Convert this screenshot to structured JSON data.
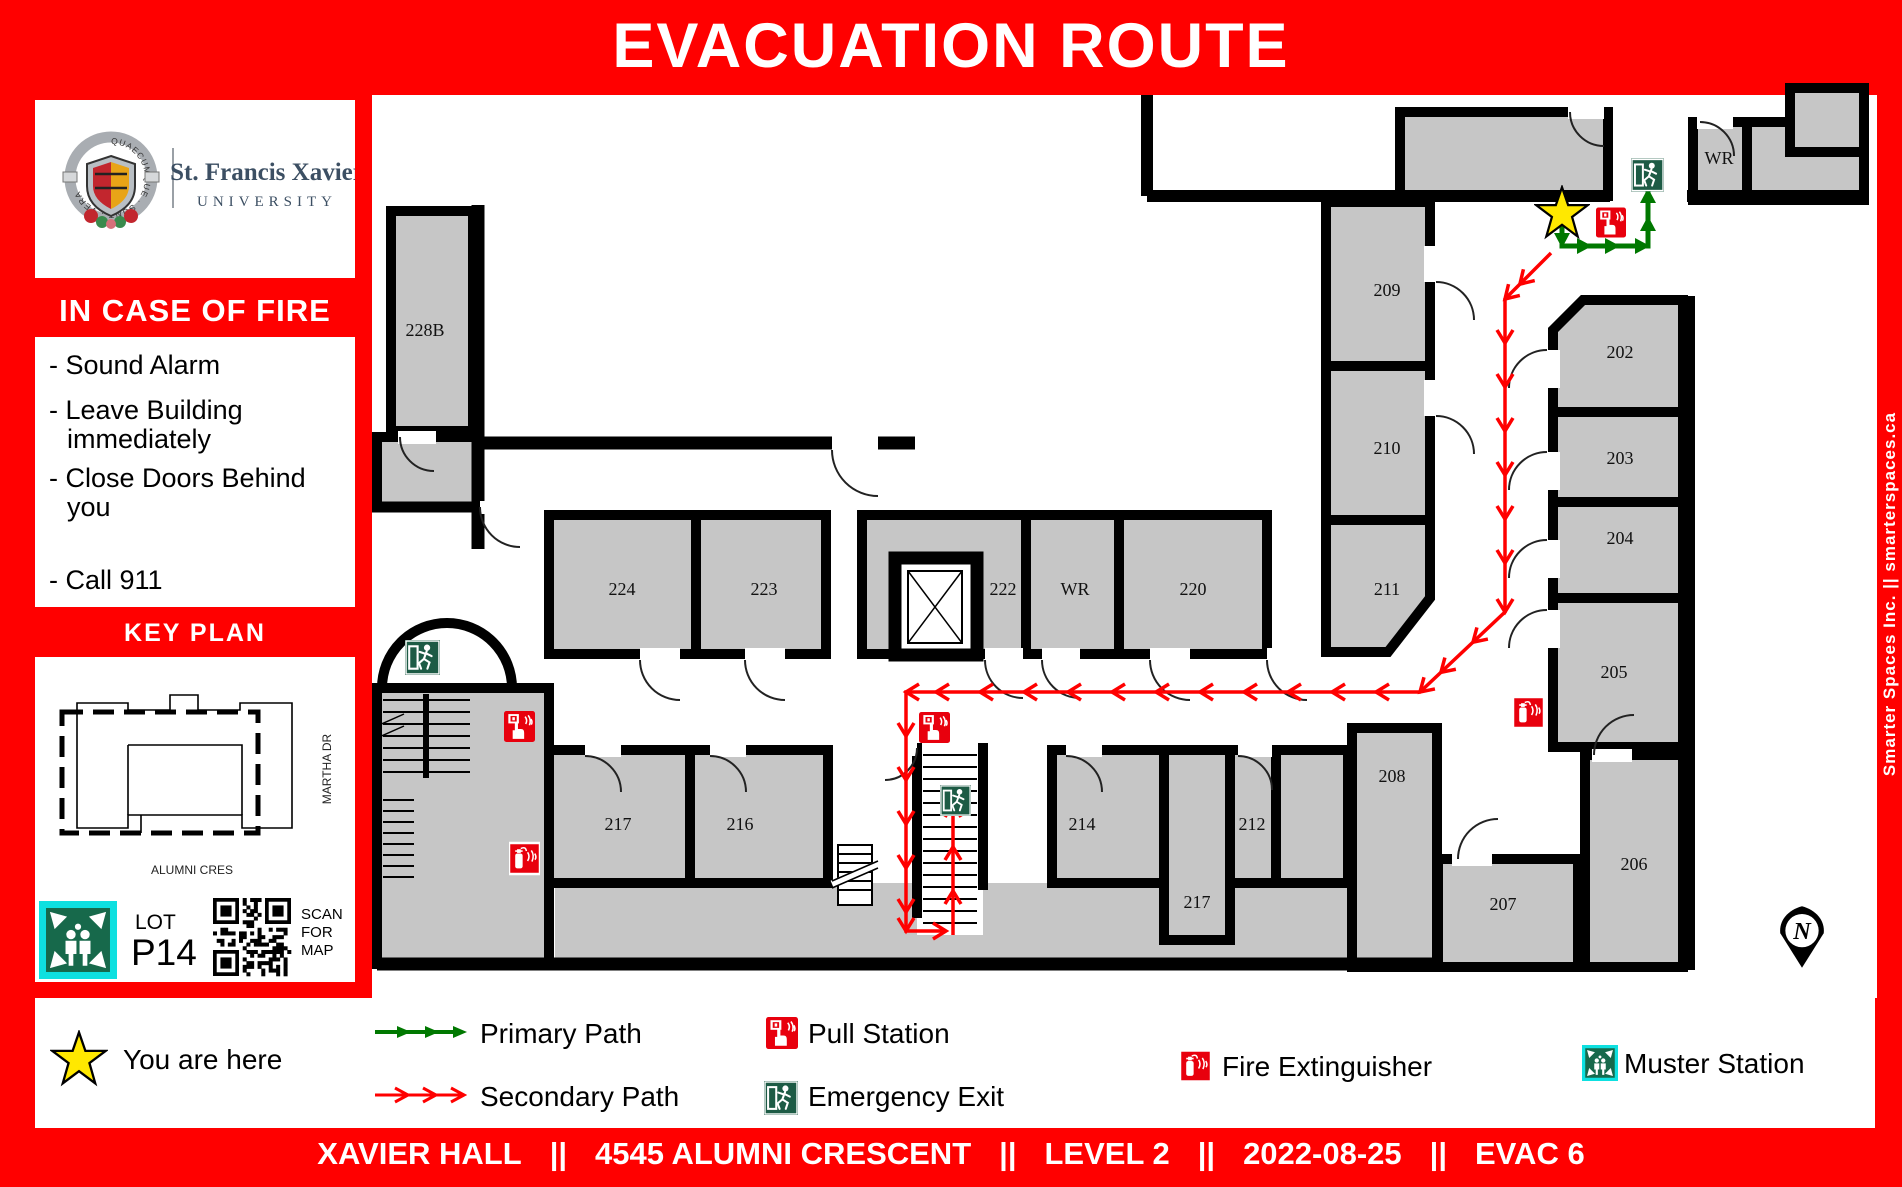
{
  "header": {
    "title": "EVACUATION ROUTE"
  },
  "right_rail": {
    "text": "Smarter Spaces Inc.    ||    smarterspaces.ca"
  },
  "sidebar": {
    "university": {
      "line1": "St. Francis Xavier",
      "line2": "UNIVERSITY",
      "motto": "QUAECUMQUE · SUNT · VERA"
    },
    "fire_heading": "IN CASE OF FIRE",
    "instructions": [
      {
        "lines": [
          "- Sound Alarm"
        ]
      },
      {
        "lines": [
          "- Leave Building",
          "immediately"
        ]
      },
      {
        "lines": [
          "- Close Doors Behind",
          "you"
        ]
      },
      {
        "lines": [
          "- Call 911"
        ]
      }
    ],
    "key_plan": {
      "heading": "KEY PLAN",
      "street_right": "MARTHA DR",
      "street_bottom": "ALUMNI CRES",
      "lot_label": "LOT",
      "lot_value": "P14",
      "qr_caption": [
        "SCAN",
        "FOR",
        "MAP"
      ]
    }
  },
  "floorplan": {
    "north_label": "N",
    "rooms": [
      {
        "label": "228B",
        "cx": 425,
        "cy": 330,
        "rect": [
          391,
          211,
          82,
          220
        ]
      },
      {
        "label": "224",
        "cx": 622,
        "cy": 589,
        "rect": [
          549,
          515,
          147,
          139
        ]
      },
      {
        "label": "223",
        "cx": 764,
        "cy": 589,
        "rect": [
          696,
          515,
          130,
          139
        ]
      },
      {
        "label": "222",
        "cx": 1003,
        "cy": 589,
        "rect": [
          862,
          515,
          164,
          139
        ]
      },
      {
        "label": "WR",
        "cx": 1075,
        "cy": 589,
        "rect": [
          1026,
          515,
          93,
          139
        ]
      },
      {
        "label": "220",
        "cx": 1193,
        "cy": 589,
        "rect": [
          1119,
          515,
          148,
          139
        ]
      },
      {
        "label": "209",
        "cx": 1387,
        "cy": 290
      },
      {
        "label": "210",
        "cx": 1387,
        "cy": 448
      },
      {
        "label": "211",
        "cx": 1387,
        "cy": 589
      },
      {
        "label": "202",
        "cx": 1620,
        "cy": 352
      },
      {
        "label": "203",
        "cx": 1620,
        "cy": 458,
        "rect": [
          1553,
          412,
          130,
          90
        ]
      },
      {
        "label": "204",
        "cx": 1620,
        "cy": 538,
        "rect": [
          1553,
          502,
          130,
          96
        ]
      },
      {
        "label": "205",
        "cx": 1614,
        "cy": 672,
        "rect": [
          1553,
          598,
          130,
          149
        ]
      },
      {
        "label": "206",
        "cx": 1634,
        "cy": 864,
        "rect": [
          1585,
          755,
          98,
          212
        ]
      },
      {
        "label": "207",
        "cx": 1503,
        "cy": 904,
        "rect": [
          1438,
          859,
          140,
          108
        ]
      },
      {
        "label": "208",
        "cx": 1392,
        "cy": 776,
        "rect": [
          1352,
          728,
          85,
          239
        ]
      },
      {
        "label": "217",
        "cx": 618,
        "cy": 824,
        "rect": [
          549,
          750,
          141,
          133
        ]
      },
      {
        "label": "216",
        "cx": 740,
        "cy": 824,
        "rect": [
          690,
          750,
          138,
          133
        ]
      },
      {
        "label": "214",
        "cx": 1082,
        "cy": 824,
        "rect": [
          1052,
          750,
          112,
          133
        ]
      },
      {
        "label": "217",
        "cx": 1197,
        "cy": 902,
        "rect": [
          1164,
          750,
          66,
          190
        ]
      },
      {
        "label": "212",
        "cx": 1252,
        "cy": 824,
        "rect": [
          1230,
          750,
          46,
          133
        ]
      },
      {
        "label": "WR",
        "cx": 1719,
        "cy": 158,
        "rect": [
          1693,
          122,
          54,
          78
        ]
      }
    ],
    "icons": [
      {
        "type": "star",
        "name": "you-are-here-star",
        "x": 1534,
        "y": 185,
        "w": 56,
        "h": 56
      },
      {
        "type": "pull",
        "name": "pull-station",
        "x": 1596,
        "y": 206,
        "w": 30,
        "h": 33
      },
      {
        "type": "exit",
        "name": "emergency-exit",
        "x": 1631,
        "y": 156,
        "w": 33,
        "h": 38
      },
      {
        "type": "exit",
        "name": "emergency-exit",
        "x": 405,
        "y": 636,
        "w": 35,
        "h": 43
      },
      {
        "type": "pull",
        "name": "pull-station",
        "x": 504,
        "y": 710,
        "w": 31,
        "h": 33
      },
      {
        "type": "ext",
        "name": "fire-extinguisher",
        "x": 509,
        "y": 839,
        "w": 31,
        "h": 39
      },
      {
        "type": "pull",
        "name": "pull-station",
        "x": 919,
        "y": 711,
        "w": 31,
        "h": 33
      },
      {
        "type": "exit",
        "name": "emergency-exit",
        "x": 940,
        "y": 780,
        "w": 31,
        "h": 41
      },
      {
        "type": "ext",
        "name": "fire-extinguisher",
        "x": 1513,
        "y": 693,
        "w": 31,
        "h": 39
      }
    ],
    "paths": {
      "primary": {
        "points": [
          [
            1562,
            222
          ],
          [
            1562,
            246
          ],
          [
            1648,
            246
          ],
          [
            1648,
            190
          ]
        ]
      },
      "secondary": [
        {
          "points": [
            [
              1551,
              253
            ],
            [
              1505,
              299
            ],
            [
              1505,
              612
            ],
            [
              1420,
              692
            ],
            [
              906,
              692
            ],
            [
              906,
              931
            ],
            [
              946,
              931
            ]
          ]
        },
        {
          "points": [
            [
              953,
              935
            ],
            [
              953,
              804
            ]
          ]
        }
      ]
    }
  },
  "legend": {
    "you_are_here": "You are here",
    "primary": "Primary Path",
    "secondary": "Secondary Path",
    "pull": "Pull Station",
    "exit": "Emergency Exit",
    "extinguisher": "Fire Extinguisher",
    "muster": "Muster Station"
  },
  "footer": {
    "segments": [
      "XAVIER HALL",
      "||",
      "4545 ALUMNI CRESCENT",
      "||",
      "LEVEL 2",
      "||",
      "2022-08-25",
      "||",
      "EVAC 6"
    ]
  },
  "colors": {
    "red": "#ff0000",
    "icon_red": "#e8000d",
    "exit_green": "#1d5b45",
    "muster_green": "#17694b",
    "muster_cyan": "#0ee0e0",
    "path_green": "#007800",
    "room_gray": "#c6c6c6",
    "star_yellow": "#ffe800"
  }
}
